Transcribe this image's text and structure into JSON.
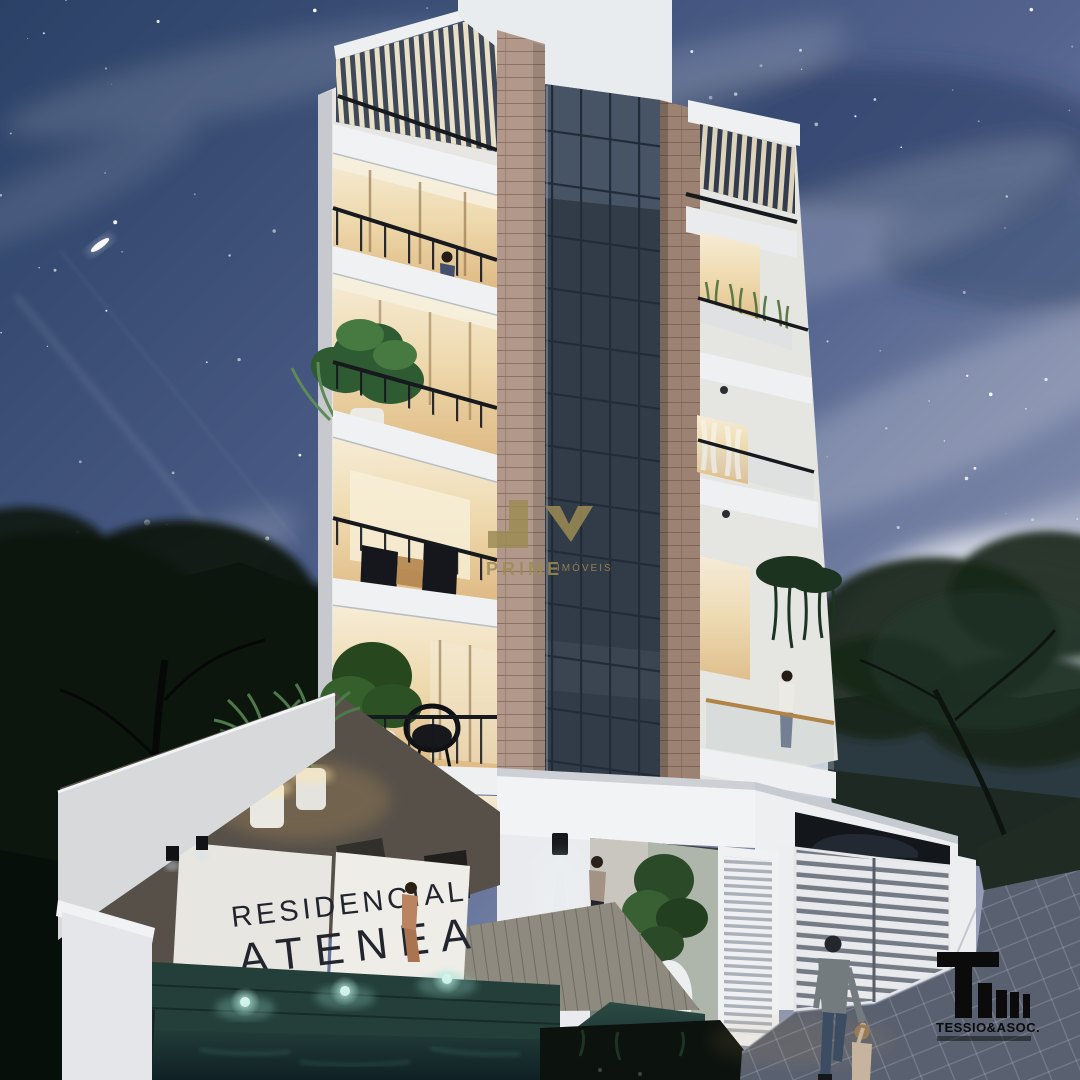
{
  "scene": {
    "description": "Night-time 3D architectural rendering of a five-storey residential building",
    "sign": {
      "line1": "RESIDENCIAL",
      "line2": "ATENEA"
    },
    "watermark": {
      "monogram": "JV",
      "brand": "PRIME",
      "suffix": "IMÓVEIS"
    },
    "developer_logo": {
      "name": "TESSIO&ASOC."
    },
    "stars": {
      "count": 130
    },
    "colors": {
      "sky_top": "#2b4166",
      "sky_mid": "#53638e",
      "sky_light": "#aab0c6",
      "gold": "#9c8c55",
      "sign_text": "#23252e",
      "logo_black": "#0b0b0c",
      "tan_light": "#b2988a",
      "tan_dark": "#9c8272",
      "glass_dark": "#323c48",
      "warm_hi": "#f7eed8",
      "warm_lo": "#ddb780",
      "white_bright": "#f2f3f4",
      "pool_teal": "#2c4b44",
      "pool_glow": "#d8f5ec",
      "foliage": "#0b150f",
      "paver": "#59606f",
      "railing": "#16191e"
    }
  }
}
